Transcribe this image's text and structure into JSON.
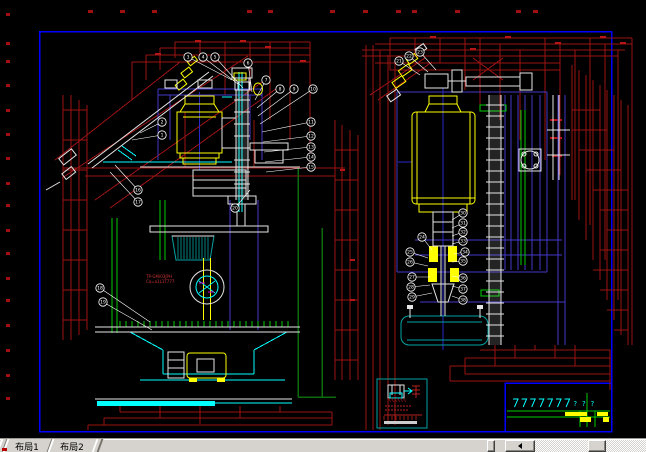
{
  "window": {
    "type": "cad-model-space",
    "canvas_bg": "#000000",
    "chrome_bg": "#d6d3ce"
  },
  "tab_bar": {
    "tabs": [
      {
        "label": "布局1",
        "active": true
      },
      {
        "label": "布局2",
        "active": false
      }
    ]
  },
  "scrollbar": {
    "direction": "horizontal",
    "left_arrow": "left"
  },
  "palette": {
    "frame_blue": "#0000ff",
    "dim_red": "#9c1212",
    "dim_red_bright": "#b81616",
    "indigo": "#4338c8",
    "center_blue": "#2929c8",
    "cyan": "#00ffff",
    "teal": "#00a3a3",
    "green": "#00cc00",
    "dark_green": "#0c6b0c",
    "yellow": "#ffff00",
    "white": "#e6e6e6",
    "magenta": "#d000d0"
  },
  "drawing": {
    "left_view": {
      "notes": [
        "TP-GM/03JPH",
        "Ca=a1L1T777"
      ],
      "balloons": [
        {
          "n": "3",
          "x": 188,
          "y": 57,
          "tx": 232,
          "ty": 80
        },
        {
          "n": "4",
          "x": 203,
          "y": 57,
          "tx": 238,
          "ty": 84
        },
        {
          "n": "5",
          "x": 215,
          "y": 57,
          "tx": 243,
          "ty": 88
        },
        {
          "n": "6",
          "x": 248,
          "y": 63,
          "tx": 252,
          "ty": 92
        },
        {
          "n": "7",
          "x": 266,
          "y": 80,
          "tx": 255,
          "ty": 100
        },
        {
          "n": "8",
          "x": 280,
          "y": 89,
          "tx": 257,
          "ty": 108
        },
        {
          "n": "9",
          "x": 294,
          "y": 89,
          "tx": 258,
          "ty": 116
        },
        {
          "n": "10",
          "x": 313,
          "y": 89,
          "tx": 260,
          "ty": 124
        },
        {
          "n": "11",
          "x": 311,
          "y": 122,
          "tx": 262,
          "ty": 132
        },
        {
          "n": "12",
          "x": 311,
          "y": 136,
          "tx": 263,
          "ty": 142
        },
        {
          "n": "13",
          "x": 311,
          "y": 147,
          "tx": 264,
          "ty": 152
        },
        {
          "n": "14",
          "x": 311,
          "y": 157,
          "tx": 265,
          "ty": 162
        },
        {
          "n": "15",
          "x": 311,
          "y": 167,
          "tx": 266,
          "ty": 172
        },
        {
          "n": "2",
          "x": 162,
          "y": 122,
          "tx": 140,
          "ty": 133
        },
        {
          "n": "1",
          "x": 162,
          "y": 135,
          "tx": 132,
          "ty": 140
        },
        {
          "n": "16",
          "x": 138,
          "y": 190,
          "tx": 115,
          "ty": 165
        },
        {
          "n": "17",
          "x": 138,
          "y": 202,
          "tx": 110,
          "ty": 172
        },
        {
          "n": "18",
          "x": 100,
          "y": 288,
          "tx": 150,
          "ty": 322
        },
        {
          "n": "19",
          "x": 103,
          "y": 302,
          "tx": 152,
          "ty": 330
        },
        {
          "n": "20",
          "x": 235,
          "y": 208,
          "tx": 250,
          "ty": 190
        }
      ]
    },
    "right_view": {
      "balloons": [
        {
          "n": "21",
          "x": 399,
          "y": 61,
          "tx": 420,
          "ty": 75
        },
        {
          "n": "22",
          "x": 409,
          "y": 56,
          "tx": 428,
          "ty": 72
        },
        {
          "n": "23",
          "x": 420,
          "y": 52,
          "tx": 436,
          "ty": 70
        },
        {
          "n": "24",
          "x": 422,
          "y": 237,
          "tx": 432,
          "ty": 250
        },
        {
          "n": "25",
          "x": 410,
          "y": 252,
          "tx": 428,
          "ty": 258
        },
        {
          "n": "26",
          "x": 410,
          "y": 262,
          "tx": 428,
          "ty": 266
        },
        {
          "n": "27",
          "x": 412,
          "y": 277,
          "tx": 430,
          "ty": 277
        },
        {
          "n": "28",
          "x": 411,
          "y": 287,
          "tx": 430,
          "ty": 285
        },
        {
          "n": "29",
          "x": 412,
          "y": 297,
          "tx": 432,
          "ty": 293
        },
        {
          "n": "30",
          "x": 463,
          "y": 213,
          "tx": 452,
          "ty": 220
        },
        {
          "n": "31",
          "x": 463,
          "y": 223,
          "tx": 452,
          "ty": 228
        },
        {
          "n": "32",
          "x": 463,
          "y": 232,
          "tx": 452,
          "ty": 236
        },
        {
          "n": "33",
          "x": 463,
          "y": 241,
          "tx": 452,
          "ty": 244
        },
        {
          "n": "34",
          "x": 465,
          "y": 252,
          "tx": 454,
          "ty": 254
        },
        {
          "n": "35",
          "x": 463,
          "y": 261,
          "tx": 452,
          "ty": 262
        },
        {
          "n": "36",
          "x": 463,
          "y": 278,
          "tx": 452,
          "ty": 276
        },
        {
          "n": "37",
          "x": 463,
          "y": 289,
          "tx": 452,
          "ty": 286
        },
        {
          "n": "38",
          "x": 463,
          "y": 300,
          "tx": 452,
          "ty": 296
        }
      ]
    },
    "title_block": {
      "border_color": "#0000ff",
      "symbols": [
        "check",
        "check",
        "check",
        "check",
        "check",
        "check",
        "check",
        "query",
        "query",
        "query"
      ]
    },
    "detail_box": {
      "border_color": "#00a3a3"
    }
  }
}
